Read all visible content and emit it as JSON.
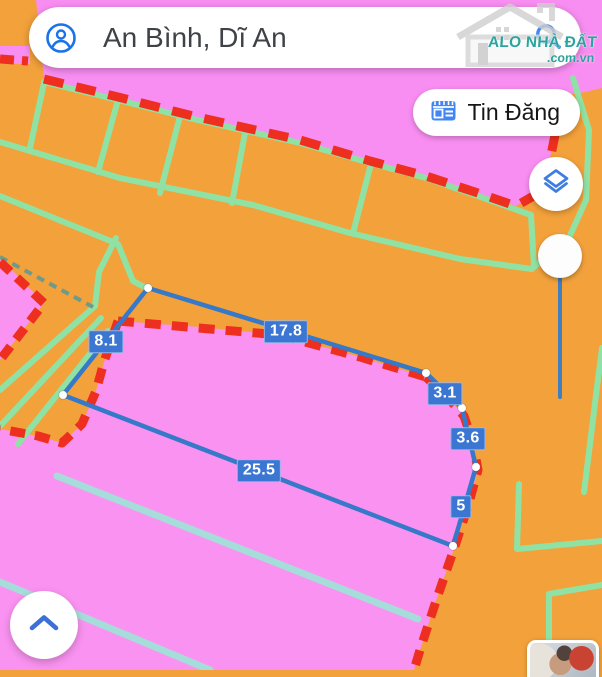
{
  "search": {
    "query": "An Bình, Dĩ An"
  },
  "watermark": {
    "brand": "ALO NHÀ ĐẤT",
    "domain": ".com.vn"
  },
  "toolbar": {
    "tin_dang_label": "Tin Đăng"
  },
  "measurements": {
    "edge_lengths": [
      8.1,
      17.8,
      3.1,
      3.6,
      5,
      25.5
    ],
    "labels": {
      "l1": "8.1",
      "l2": "17.8",
      "l3": "3.1",
      "l4": "3.6",
      "l5": "5",
      "l6": "25.5"
    }
  },
  "colors": {
    "map_orange": "#f2a13b",
    "parcel_pink": "#f992f0",
    "zoning_red": "#ee2e1e",
    "parcel_line_teal": "#90e2a4",
    "parcel_line_cyan": "#a6dcd9",
    "measure_blue": "#3579c8",
    "badge_blue": "#3b76d2",
    "icon_blue": "#4285f4",
    "watermark_teal": "#2ba49d"
  }
}
